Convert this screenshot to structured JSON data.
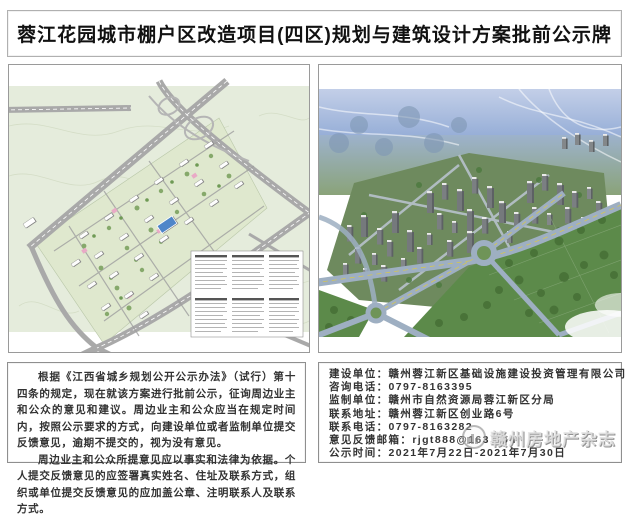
{
  "title": "蓉江花园城市棚户区改造项目(四区)规划与建筑设计方案批前公示牌",
  "notice": {
    "paragraph1": "根据《江西省城乡规划公开公示办法》（试行）第十四条的规定，现在就该方案进行批前公示，征询周边业主和公众的意见和建议。周边业主和公众应当在规定时间内，按照公示要求的方式，向建设单位或者监制单位提交反馈意见，逾期不提交的，视为没有意见。",
    "paragraph2": "周边业主和公众所提意见应以事实和法律为依据。个人提交反馈意见的应签署真实姓名、住址及联系方式，组织或单位提交反馈意见的应加盖公章、注明联系人及联系方式。"
  },
  "info": {
    "lines": [
      {
        "label": "建设单位：",
        "value": "赣州蓉江新区基础设施建设投资管理有限公司"
      },
      {
        "label": "咨询电话：",
        "value": "0797-8163395"
      },
      {
        "label": "监制单位：",
        "value": "赣州市自然资源局蓉江新区分局"
      },
      {
        "label": "联系地址：",
        "value": "赣州蓉江新区创业路6号"
      },
      {
        "label": "联系电话：",
        "value": "0797-8163282"
      },
      {
        "label": "意见反馈邮箱：",
        "value": "rjgt888@163.com"
      },
      {
        "label": "公示时间：",
        "value": "2021年7月22日-2021年7月30日"
      }
    ]
  },
  "watermark": {
    "text": "赣州房地产杂志"
  },
  "panels": {
    "left_type": "site-plan-drawing",
    "right_type": "aerial-rendering"
  },
  "colors": {
    "plan_background": "#e5ecdc",
    "plan_road": "#a9a9a9",
    "render_sky": "#93abd6",
    "render_field": "#5c8a4a",
    "border": "#9a9a9a"
  }
}
